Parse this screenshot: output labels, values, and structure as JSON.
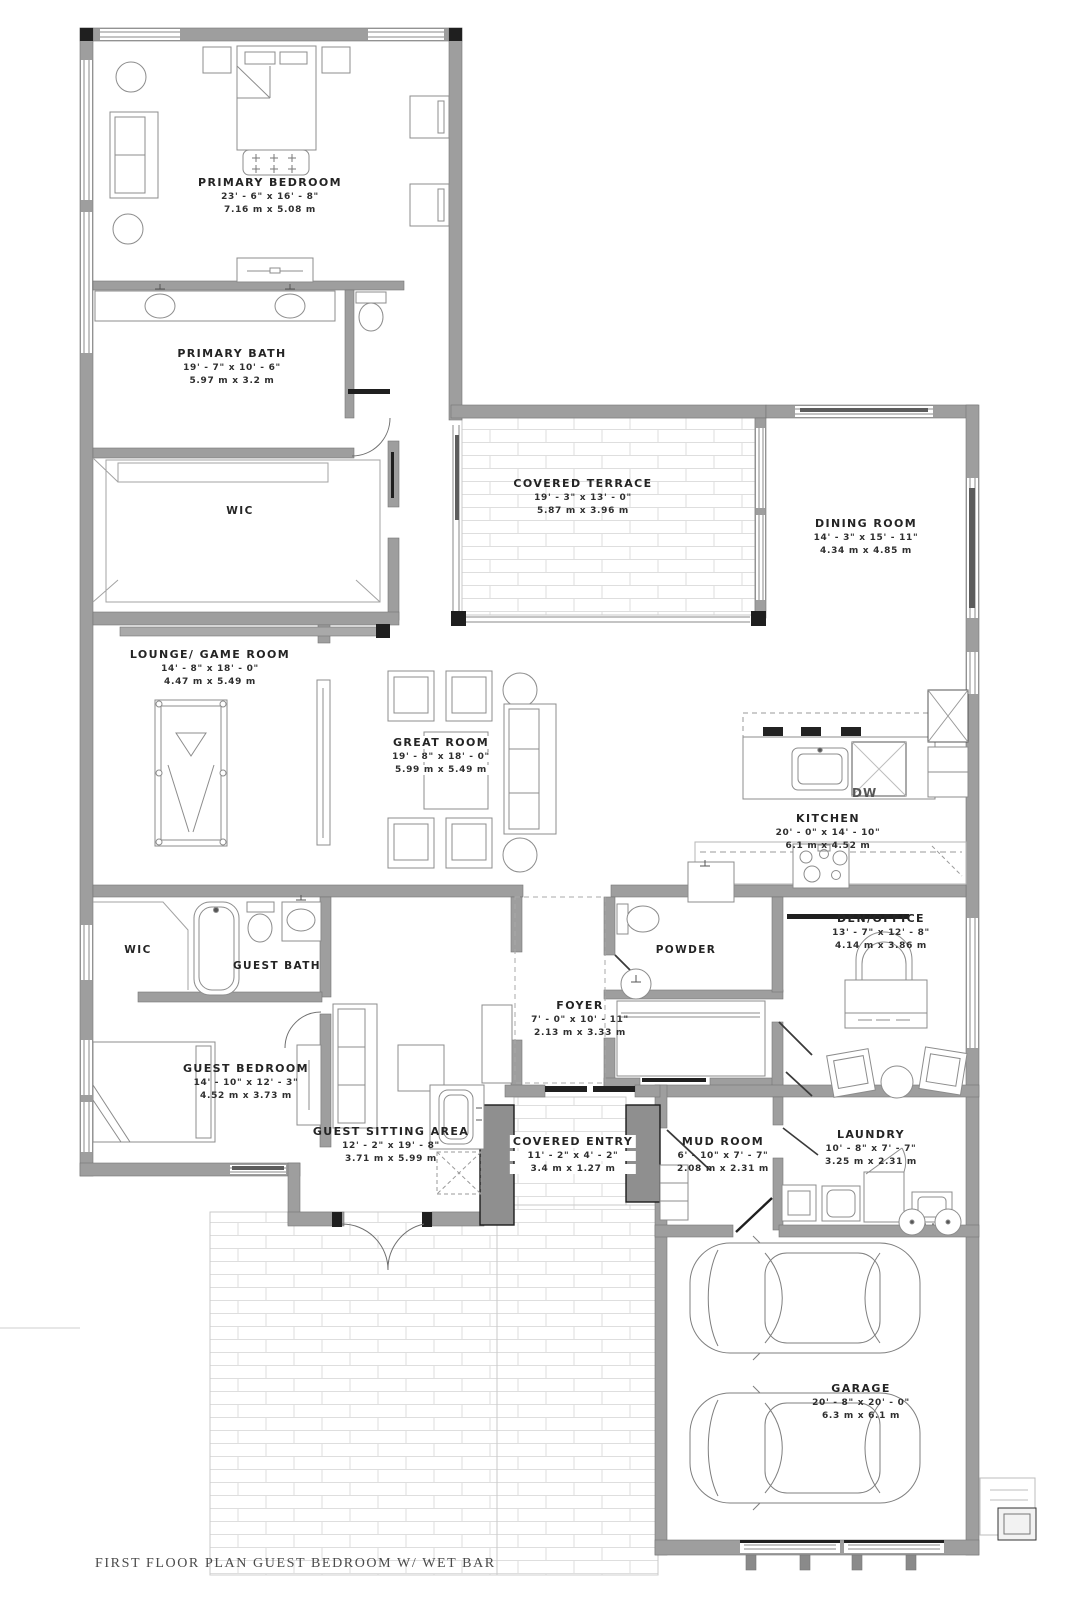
{
  "title": "FIRST FLOOR PLAN GUEST BEDROOM W/ WET BAR",
  "labels": {
    "dw": "DW"
  },
  "rooms": [
    {
      "id": "primary-bedroom",
      "name": "PRIMARY BEDROOM",
      "imperial": "23' - 6\" x 16' - 8\"",
      "metric": "7.16 m x 5.08 m"
    },
    {
      "id": "primary-bath",
      "name": "PRIMARY BATH",
      "imperial": "19' - 7\" x 10' - 6\"",
      "metric": "5.97 m x 3.2 m"
    },
    {
      "id": "primary-wic",
      "name": "WIC"
    },
    {
      "id": "covered-terrace",
      "name": "COVERED TERRACE",
      "imperial": "19' - 3\" x 13' - 0\"",
      "metric": "5.87 m x 3.96 m"
    },
    {
      "id": "dining-room",
      "name": "DINING ROOM",
      "imperial": "14' - 3\" x 15' - 11\"",
      "metric": "4.34 m x 4.85 m"
    },
    {
      "id": "lounge-game-room",
      "name": "LOUNGE/ GAME ROOM",
      "imperial": "14' - 8\" x 18' - 0\"",
      "metric": "4.47 m x 5.49 m"
    },
    {
      "id": "great-room",
      "name": "GREAT ROOM",
      "imperial": "19' - 8\" x 18' - 0\"",
      "metric": "5.99 m x 5.49 m"
    },
    {
      "id": "kitchen",
      "name": "KITCHEN",
      "imperial": "20' - 0\" x 14' - 10\"",
      "metric": "6.1 m x 4.52 m"
    },
    {
      "id": "den-office",
      "name": "DEN/OFFICE",
      "imperial": "13' - 7\" x 12' - 8\"",
      "metric": "4.14 m x 3.86 m"
    },
    {
      "id": "powder",
      "name": "POWDER"
    },
    {
      "id": "foyer",
      "name": "FOYER",
      "imperial": "7' - 0\" x 10' - 11\"",
      "metric": "2.13 m x 3.33 m"
    },
    {
      "id": "guest-wic",
      "name": "WIC"
    },
    {
      "id": "guest-bath",
      "name": "GUEST BATH"
    },
    {
      "id": "guest-bedroom",
      "name": "GUEST BEDROOM",
      "imperial": "14' - 10\" x 12' - 3\"",
      "metric": "4.52 m x 3.73 m"
    },
    {
      "id": "guest-sitting-area",
      "name": "GUEST SITTING AREA",
      "imperial": "12' - 2\" x 19' - 8\"",
      "metric": "3.71 m x 5.99 m"
    },
    {
      "id": "covered-entry",
      "name": "COVERED ENTRY",
      "imperial": "11' - 2\" x 4' - 2\"",
      "metric": "3.4 m x 1.27 m"
    },
    {
      "id": "mud-room",
      "name": "MUD ROOM",
      "imperial": "6' - 10\" x 7' - 7\"",
      "metric": "2.08 m x 2.31 m"
    },
    {
      "id": "laundry",
      "name": "LAUNDRY",
      "imperial": "10' - 8\" x 7' - 7\"",
      "metric": "3.25 m x 2.31 m"
    },
    {
      "id": "garage",
      "name": "GARAGE",
      "imperial": "20' - 8\" x 20' - 0\"",
      "metric": "6.3 m x 6.1 m"
    }
  ]
}
